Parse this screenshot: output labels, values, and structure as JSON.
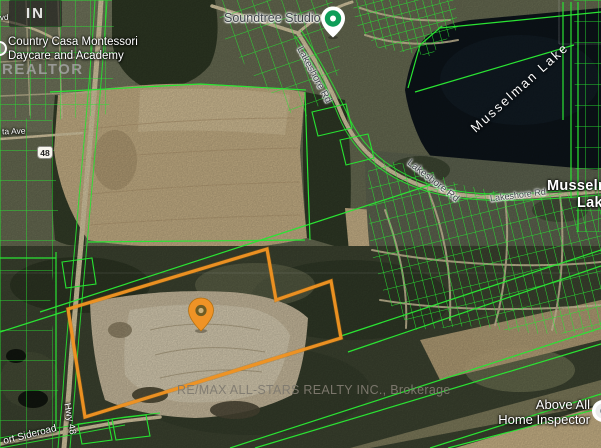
{
  "watermarks": {
    "logo": "IN",
    "realtor": "REALTOR",
    "brokerage": "RE/MAX ALL-STARS REALTY INC., Brokerage"
  },
  "pois": {
    "daycare": {
      "line1": "Country Casa Montessori",
      "line2": "Daycare and Academy"
    },
    "studio": {
      "name": "Soundtree Studio"
    },
    "inspector": {
      "line1": "Above All",
      "line2": "Home Inspector"
    }
  },
  "places": {
    "lake": "Musselman Lake",
    "town_line1": "Musselman",
    "town_line2": "Lake"
  },
  "roads": {
    "blvd_partial": "vd",
    "ta_ave": "ta Ave",
    "shield": "48",
    "hwy48": "Hwy 48",
    "sideroad_partial": "ort Sideroad",
    "lakeshore_upper": "Lakeshore Rd",
    "lakeshore_mid": "Lakeshore Rd",
    "lakeshore_right": "Lakeshore Rd"
  },
  "colors": {
    "parcel_line": "#27e331",
    "property_outline": "#ef9322",
    "property_pin": "#ef9326",
    "poi_pin": "#0f9d58",
    "lake_water": "#0d141a",
    "field_tan": "#c6b086",
    "forest": "#3c4330",
    "road": "#d7c9a3"
  }
}
